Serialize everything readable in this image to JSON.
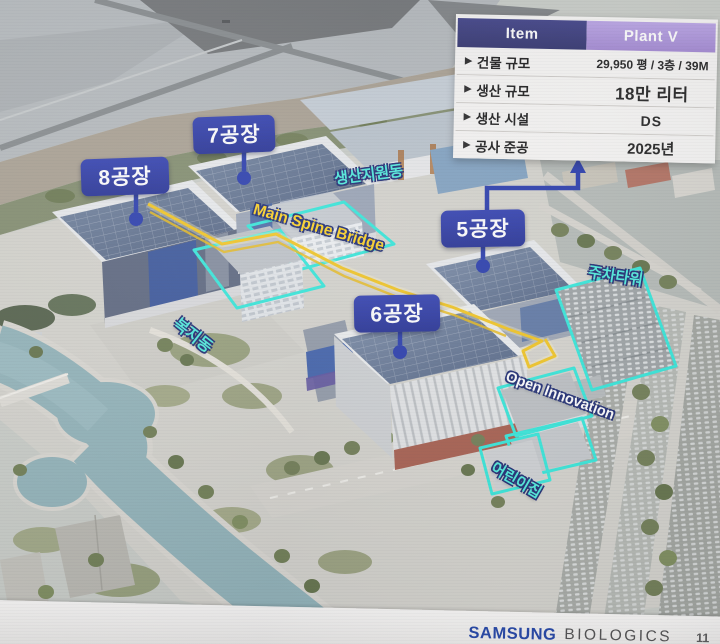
{
  "slide": {
    "table": {
      "marker": "▶",
      "header": {
        "item": "Item",
        "plant": "Plant V"
      },
      "rows": [
        {
          "item": "건물 규모",
          "value": "29,950 평 / 3층 / 39M"
        },
        {
          "item": "생산 규모",
          "value": "18만 리터"
        },
        {
          "item": "생산 시설",
          "value": "DS"
        },
        {
          "item": "공사 준공",
          "value": "2025년"
        }
      ]
    },
    "plant_labels": {
      "plant8": "8공장",
      "plant7": "7공장",
      "plant5": "5공장",
      "plant6": "6공장"
    },
    "annotations": {
      "production_support": "생산지원동",
      "main_spine_bridge": "Main Spine Bridge",
      "welfare": "복지동",
      "parking_tower": "주차타워",
      "open_innovation": "Open Innovation",
      "daycare": "어린이집"
    },
    "footer": {
      "brand": "SAMSUNG",
      "brand_suffix": "BIOLOGICS",
      "page": "11"
    },
    "colors": {
      "label_blue": "#2532a4",
      "annotation_cyan": "#49ecdc",
      "route_yellow": "#f3c51c",
      "header_navy": "#32347c",
      "header_purple": "#ab92dc",
      "samsung_blue": "#1b3fa5"
    }
  }
}
